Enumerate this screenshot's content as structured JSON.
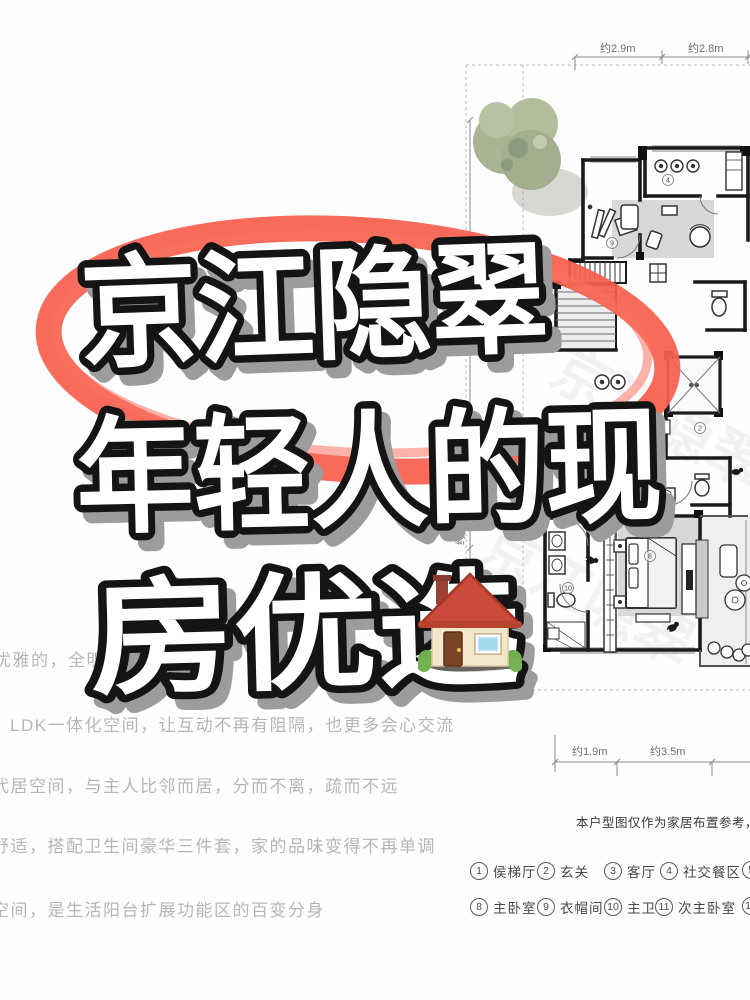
{
  "title": {
    "line1": "京江隐翠",
    "line2": "年轻人的现",
    "line3": "房优选",
    "house_icon": "house-emoji"
  },
  "left_text": {
    "line1_prefix": "优雅的，全明",
    "line1_suffix": "回家",
    "line2": "LDK一体化空间，让互动不再有阻隔，也更多会心交流",
    "line3": "代居空间，与主人比邻而居，分而不离，疏而不远",
    "line4": "舒适，搭配卫生间豪华三件套，家的品味变得不再单调",
    "line5": "空间，是生活阳台扩展功能区的百变分身"
  },
  "floorplan": {
    "dimensions": {
      "top": [
        "约2.9m",
        "约2.8m"
      ],
      "left": [
        "约1.15m",
        "约0.7m"
      ],
      "bottom": [
        "约1.9m",
        "约3.5m"
      ]
    },
    "markers": [
      "2",
      "4",
      "7",
      "8",
      "9",
      "10"
    ]
  },
  "disclaimer": "本户型图仅作为家居布置参考，交付标准以",
  "legend": {
    "row1": [
      {
        "num": "1",
        "label": "侯梯厅"
      },
      {
        "num": "2",
        "label": "玄关"
      },
      {
        "num": "3",
        "label": "客厅"
      },
      {
        "num": "4",
        "label": "社交餐区"
      },
      {
        "num": "5",
        "label": ""
      }
    ],
    "row2": [
      {
        "num": "8",
        "label": "主卧室"
      },
      {
        "num": "9",
        "label": "衣帽间"
      },
      {
        "num": "10",
        "label": "主卫"
      },
      {
        "num": "11",
        "label": "次主卧室"
      },
      {
        "num": "12",
        "label": ""
      }
    ]
  },
  "colors": {
    "marker_red": "#F8604E",
    "title_fill": "#FFFFFF",
    "title_outline": "#141414",
    "title_shadow": "#9C9C9C",
    "muted_text": "#B6B6B6",
    "legend_text": "#474747"
  }
}
